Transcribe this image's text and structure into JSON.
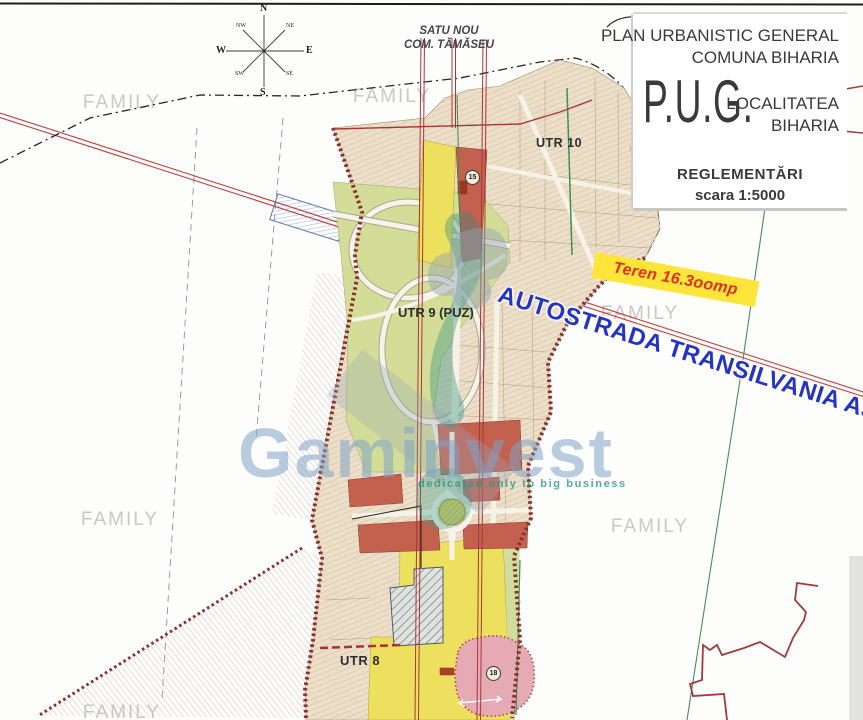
{
  "document": {
    "type": "urban planning map (scanned)",
    "top_scan_line": true
  },
  "title_block": {
    "line1": "PLAN URBANISTIC GENERAL",
    "line2": "COMUNA BIHARIA",
    "acronym": "P.U.G.",
    "locality_line1": "LOCALITATEA",
    "locality_line2": "BIHARIA",
    "subtitle": "REGLEMENTĂRI",
    "scale": "scara 1:5000"
  },
  "neighbor_label": {
    "line1": "SATU NOU",
    "line2": "COM. TĂMĂSEU"
  },
  "compass": {
    "n": "N",
    "ne": "NE",
    "e": "E",
    "se": "SE",
    "s": "S",
    "sw": "SW",
    "w": "W",
    "nw": "NW"
  },
  "zones": {
    "utr10": "UTR 10",
    "utr9": "UTR 9 (PUZ)",
    "utr8": "UTR 8"
  },
  "annotations": {
    "parcel_highlight": "Teren 16.3oomp",
    "highway": "AUTOSTRADA TRANSILVANIA A3"
  },
  "markers": {
    "zone15": "15",
    "zone18": "18"
  },
  "watermarks": {
    "family": "FAMILY",
    "brand": "Gaminvest",
    "brand_tagline": "dedicated only to big business"
  },
  "colors": {
    "map_beige": "#e9dcc6",
    "zone_yellow": "#ece05e",
    "zone_red": "#c4604e",
    "zone_green": "#d4dd97",
    "zone_pink": "#e6aab4",
    "hatch_zone_gray": "#6b7585",
    "boundary_dark_red": "#8a2f2f",
    "railway_red": "#c04040",
    "banner_yellow": "#ffe53a",
    "banner_text_red": "#e0301e",
    "highway_text_blue": "#2334c6",
    "watermark_gray": "#bababa",
    "brand_blue": "#80a3c6",
    "tagline_teal": "#2a9684"
  }
}
